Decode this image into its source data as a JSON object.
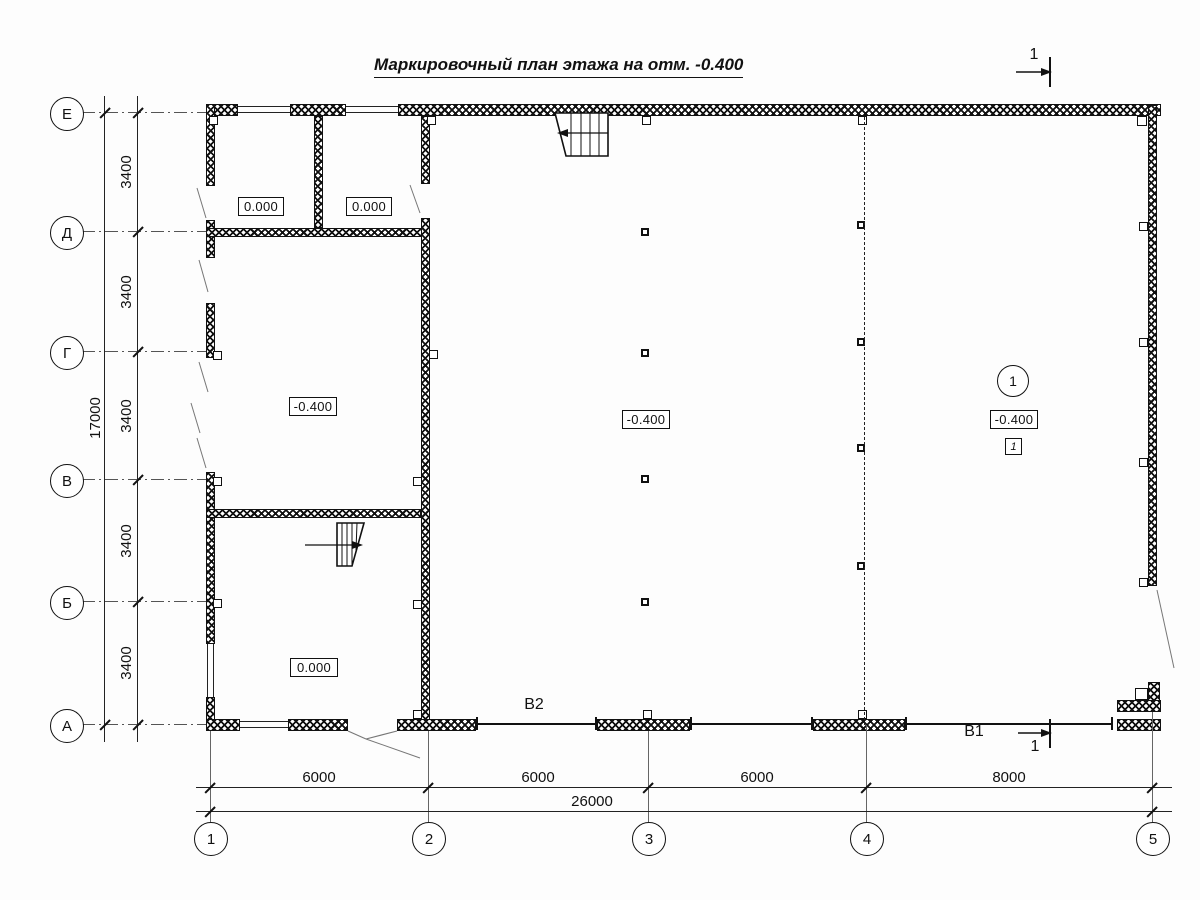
{
  "title": "Маркировочный план этажа на отм. -0.400",
  "grid": {
    "rows": [
      {
        "label": "Е"
      },
      {
        "label": "Д"
      },
      {
        "label": "Г"
      },
      {
        "label": "В"
      },
      {
        "label": "Б"
      },
      {
        "label": "А"
      }
    ],
    "cols": [
      {
        "label": "1"
      },
      {
        "label": "2"
      },
      {
        "label": "3"
      },
      {
        "label": "4"
      },
      {
        "label": "5"
      }
    ]
  },
  "dims": {
    "row_spacings": [
      "3400",
      "3400",
      "3400",
      "3400",
      "3400"
    ],
    "row_total": "17000",
    "col_spacings": [
      "6000",
      "6000",
      "6000",
      "8000"
    ],
    "col_total": "26000"
  },
  "elevations": {
    "top_room_1": "0.000",
    "top_room_2": "0.000",
    "left_room": "-0.400",
    "bottom_room": "0.000",
    "hall": "-0.400",
    "right_zone": "-0.400"
  },
  "marks": {
    "section_top": "1",
    "section_bottom": "1",
    "v1": "В1",
    "v2": "В2",
    "zone_circle": "1",
    "zone_square": "1"
  },
  "colors": {
    "ink": "#111111",
    "leader": "#777777"
  }
}
